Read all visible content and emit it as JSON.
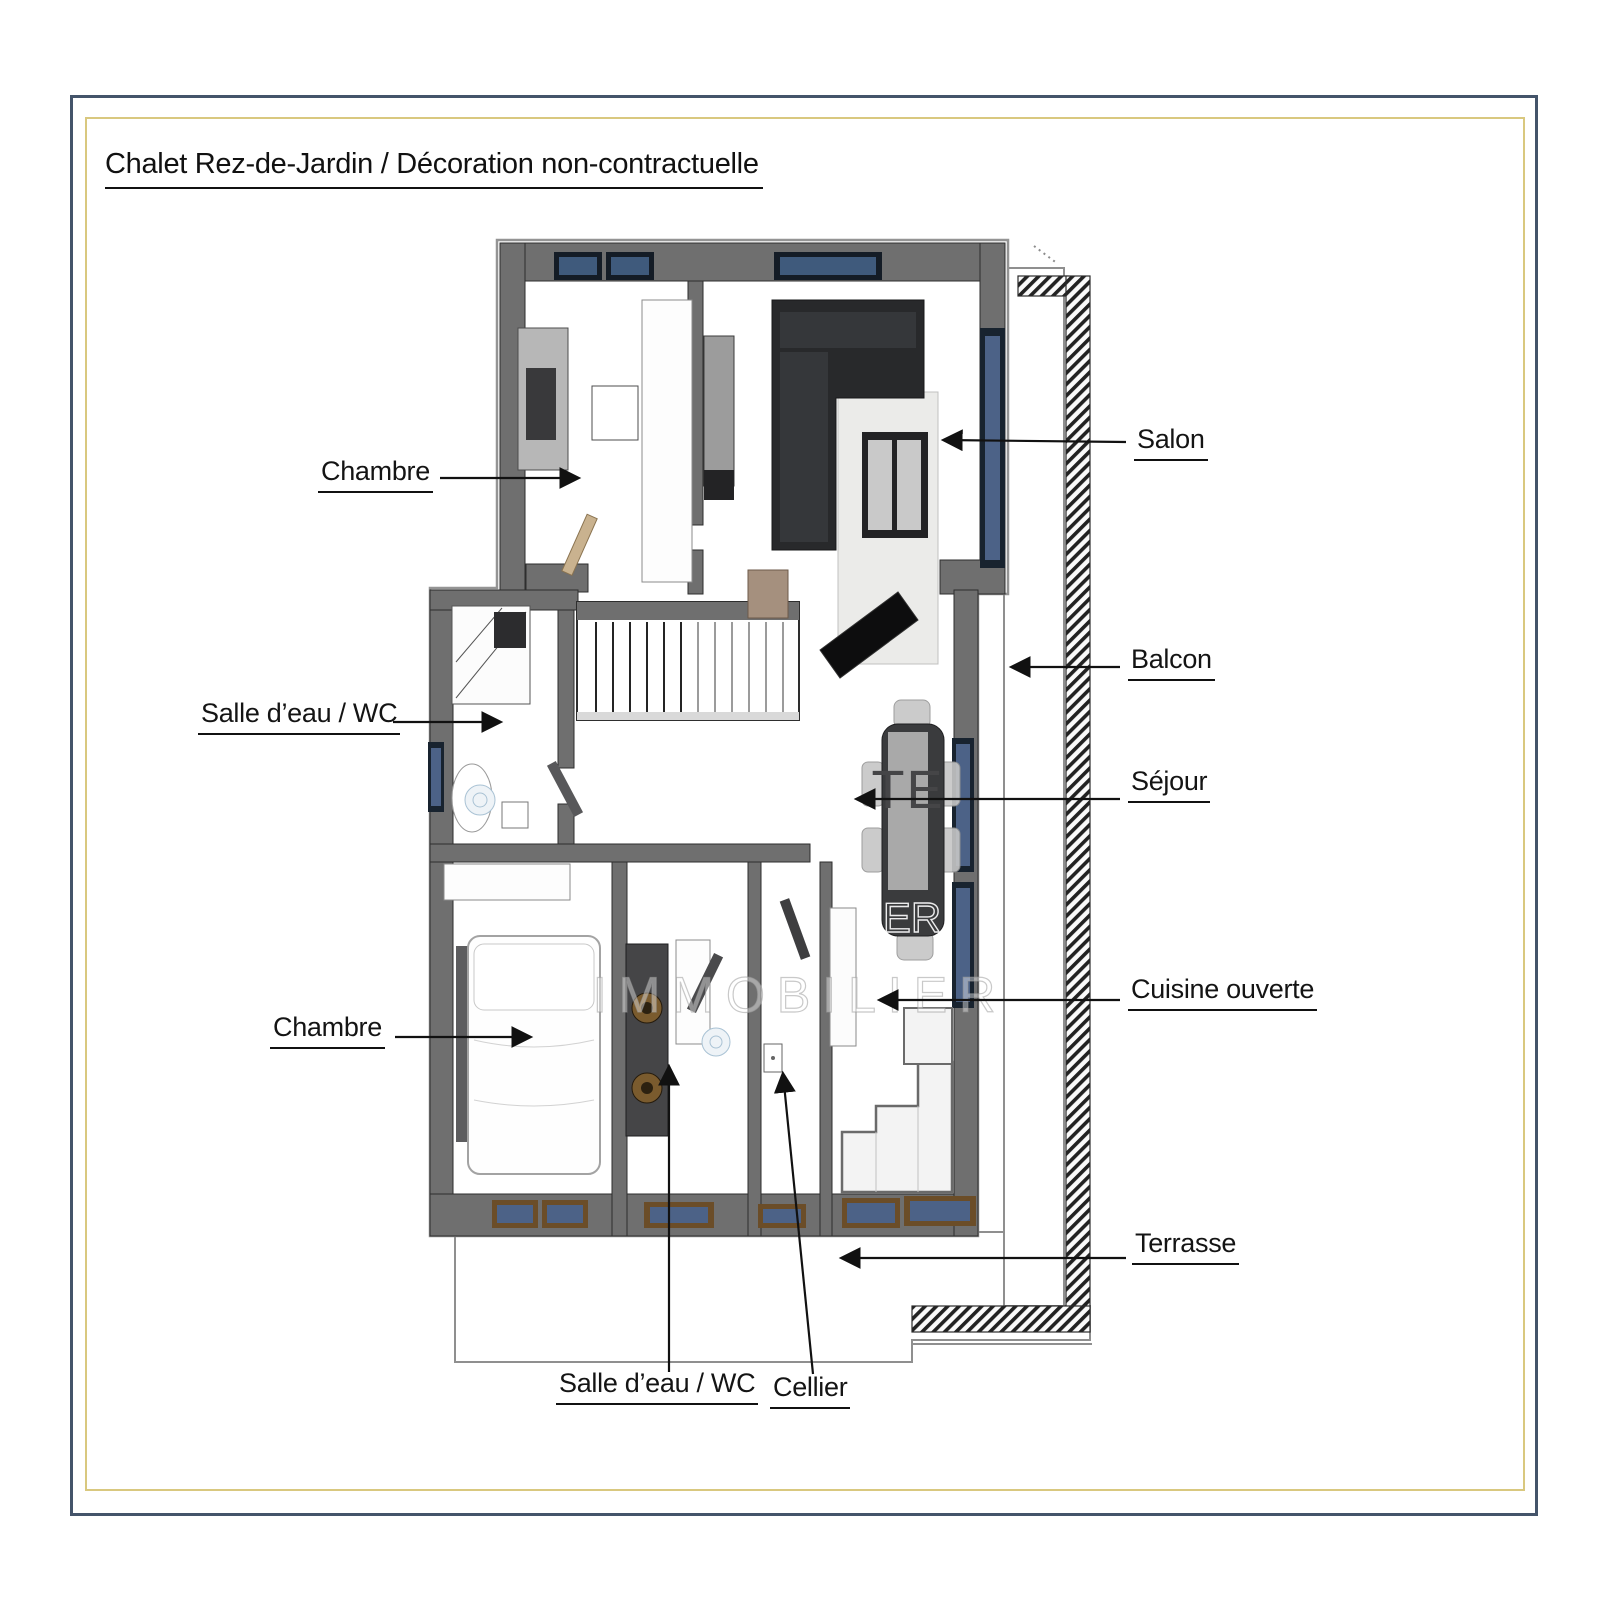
{
  "page": {
    "title": "Chalet Rez-de-Jardin / Décoration non-contractuelle"
  },
  "labels": {
    "chambre_top": "Chambre",
    "salle_eau_left": "Salle d’eau / WC",
    "chambre_bottom": "Chambre",
    "salon": "Salon",
    "balcon": "Balcon",
    "sejour": "Séjour",
    "cuisine": "Cuisine ouverte",
    "terrasse": "Terrasse",
    "salle_eau_bottom": "Salle d’eau / WC",
    "cellier": "Cellier"
  },
  "watermark": {
    "fragment_table": "TE",
    "fragment_table_lower": "ER",
    "brand": "IMMOBILIER"
  },
  "colors": {
    "outer_border": "#44546a",
    "inner_border": "#d9c87f",
    "wall": "#6f6f6f",
    "window_glass": "#4c6287",
    "window_frame": "#18232f",
    "sill_wood": "#6b4d28",
    "label_text": "#141414"
  }
}
